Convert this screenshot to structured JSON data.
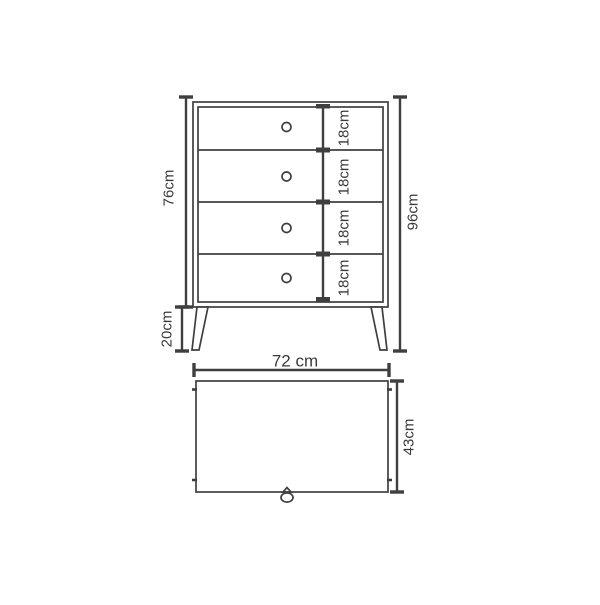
{
  "colors": {
    "line": "#3f3f3f",
    "text": "#3a3a3a",
    "background": "#ffffff"
  },
  "front_view": {
    "body_height": "76cm",
    "leg_height": "20cm",
    "total_height": "96cm",
    "drawer_heights": [
      "18cm",
      "18cm",
      "18cm",
      "18cm"
    ]
  },
  "top_view": {
    "width": "72 cm",
    "depth": "43cm"
  }
}
